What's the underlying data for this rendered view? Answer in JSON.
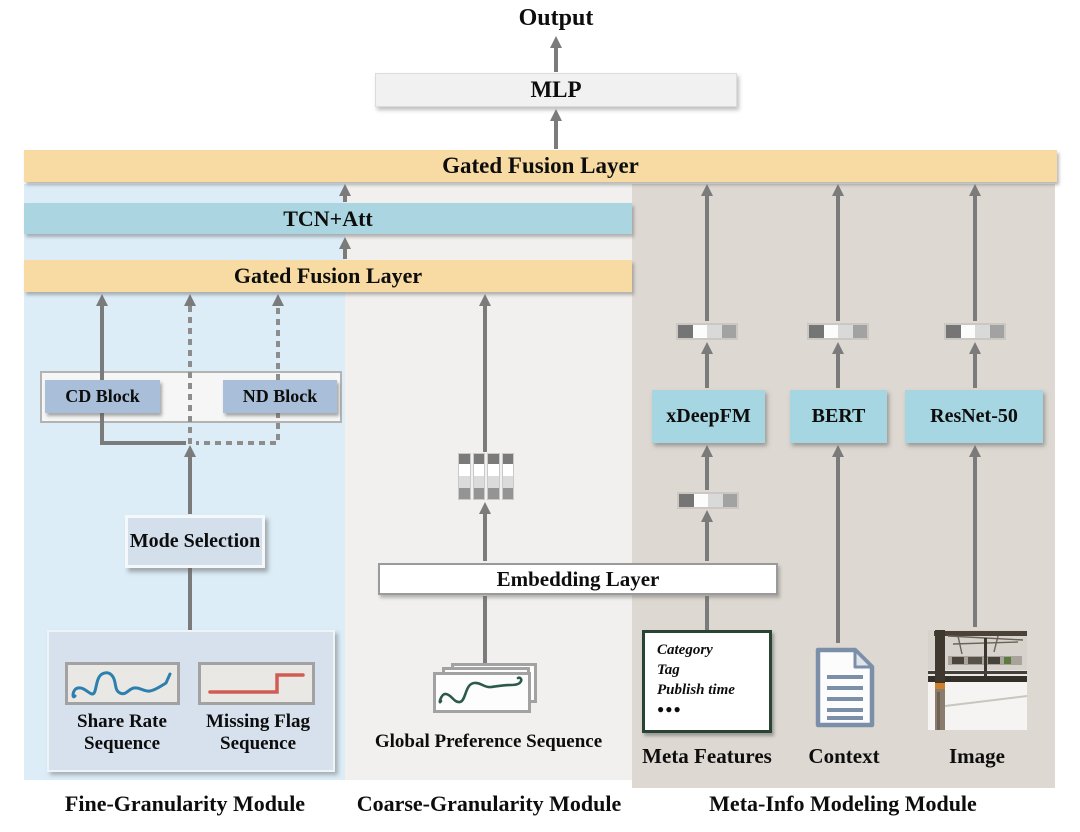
{
  "palette": {
    "fusion_bar": "#f7dba2",
    "tcn_bar": "#abd6e1",
    "model_box": "#a6d6e1",
    "fine_panel": "#dcedf7",
    "coarse_panel": "#f1f0ee",
    "meta_panel": "#ddd8d2",
    "block_fill": "#a9bed9",
    "mode_fill": "#d4dfec",
    "sequence_container": "#d7e1ee",
    "arrow": "#7b7b7b",
    "share_curve": "#2d7fae",
    "missing_step": "#cf5d53",
    "preference_curve": "#2c5a49",
    "meta_box_border": "#2a4434"
  },
  "output": {
    "label": "Output"
  },
  "mlp": {
    "label": "MLP"
  },
  "fusion_top": {
    "label": "Gated Fusion Layer"
  },
  "tcn": {
    "label": "TCN+Att"
  },
  "fusion_mid": {
    "label": "Gated Fusion Layer"
  },
  "fine": {
    "title": "Fine-Granularity Module",
    "cd_block": "CD Block",
    "nd_block": "ND Block",
    "mode_selection": "Mode Selection",
    "share_label": "Share Rate\nSequence",
    "missing_label": "Missing Flag\nSequence"
  },
  "coarse": {
    "title": "Coarse-Granularity Module",
    "embedding": "Embedding Layer",
    "global_label": "Global Preference Sequence"
  },
  "meta": {
    "title": "Meta-Info Modeling Module",
    "columns": [
      {
        "model": "xDeepFM",
        "source": "Meta Features"
      },
      {
        "model": "BERT",
        "source": "Context"
      },
      {
        "model": "ResNet-50",
        "source": "Image"
      }
    ],
    "features": {
      "items": [
        "Category",
        "Tag",
        "Publish time"
      ],
      "dots": "●●●"
    }
  }
}
